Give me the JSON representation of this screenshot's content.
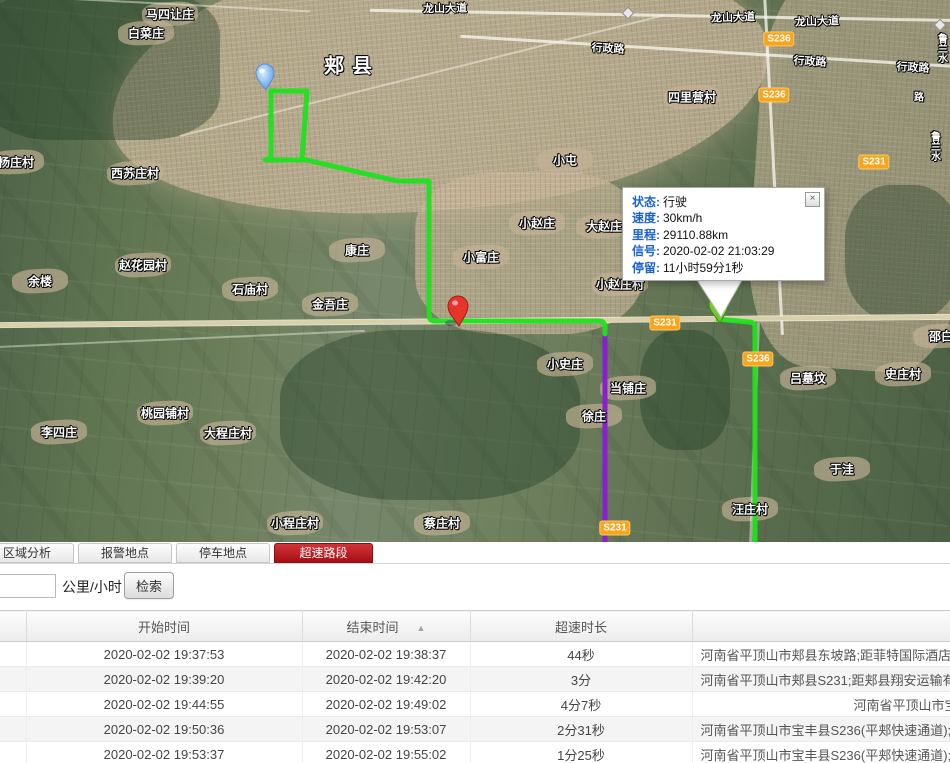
{
  "map": {
    "popup": {
      "rows": [
        {
          "label": "状态:",
          "value": "行驶"
        },
        {
          "label": "速度:",
          "value": "30km/h"
        },
        {
          "label": "里程:",
          "value": "29110.88km"
        },
        {
          "label": "信号:",
          "value": "2020-02-02 21:03:29"
        },
        {
          "label": "停留:",
          "value": "11小时59分1秒"
        }
      ],
      "close": "×"
    },
    "route_colors": {
      "track": "#1fe11f",
      "overspeed": "#8a1fd2"
    },
    "markers": [
      "start-balloon-marker",
      "red-pin-marker",
      "vehicle-green-marker"
    ],
    "labels": [
      {
        "text": "马四让庄",
        "x": 170,
        "y": 14,
        "blob": true
      },
      {
        "text": "白菜庄",
        "x": 146,
        "y": 33,
        "blob": true
      },
      {
        "text": "龙山大道",
        "x": 445,
        "y": 8,
        "size": 11,
        "rot": -1
      },
      {
        "text": "龙山大道",
        "x": 733,
        "y": 17,
        "size": 11,
        "rot": -2
      },
      {
        "text": "龙山大道",
        "x": 817,
        "y": 21,
        "size": 11,
        "rot": -2
      },
      {
        "text": "行政路",
        "x": 608,
        "y": 48,
        "size": 11,
        "rot": 3
      },
      {
        "text": "行政路",
        "x": 810,
        "y": 61,
        "size": 11,
        "rot": 3
      },
      {
        "text": "行政路",
        "x": 913,
        "y": 67,
        "size": 11,
        "rot": 3
      },
      {
        "text": "郏县",
        "x": 352,
        "y": 64,
        "size": 20,
        "ls": 8
      },
      {
        "text": "四里营村",
        "x": 692,
        "y": 97,
        "blob": true
      },
      {
        "text": "小屯",
        "x": 565,
        "y": 160,
        "blob": true
      },
      {
        "text": "杨庄村",
        "x": 16,
        "y": 162,
        "blob": true
      },
      {
        "text": "西苏庄村",
        "x": 135,
        "y": 173,
        "blob": true
      },
      {
        "text": "小赵庄",
        "x": 537,
        "y": 223,
        "blob": true
      },
      {
        "text": "大赵庄",
        "x": 604,
        "y": 226,
        "blob": true
      },
      {
        "text": "康庄",
        "x": 357,
        "y": 250,
        "blob": true
      },
      {
        "text": "小富庄",
        "x": 481,
        "y": 257,
        "blob": true
      },
      {
        "text": "赵花园村",
        "x": 143,
        "y": 265,
        "blob": true
      },
      {
        "text": "余楼",
        "x": 40,
        "y": 281,
        "blob": true
      },
      {
        "text": "石庙村",
        "x": 250,
        "y": 289,
        "blob": true
      },
      {
        "text": "金吾庄",
        "x": 330,
        "y": 304,
        "blob": true
      },
      {
        "text": "小赵庄村",
        "x": 620,
        "y": 284,
        "blob": true
      },
      {
        "text": "邵白",
        "x": 941,
        "y": 336,
        "blob": true
      },
      {
        "text": "小史庄",
        "x": 565,
        "y": 364,
        "blob": true
      },
      {
        "text": "当铺庄",
        "x": 628,
        "y": 388,
        "blob": true
      },
      {
        "text": "吕墓坟",
        "x": 808,
        "y": 378,
        "blob": true
      },
      {
        "text": "史庄村",
        "x": 903,
        "y": 374,
        "blob": true
      },
      {
        "text": "徐庄",
        "x": 594,
        "y": 416,
        "blob": true
      },
      {
        "text": "于洼",
        "x": 842,
        "y": 469,
        "blob": true
      },
      {
        "text": "汪庄村",
        "x": 750,
        "y": 509,
        "blob": true
      },
      {
        "text": "李四庄",
        "x": 59,
        "y": 432,
        "blob": true
      },
      {
        "text": "桃园铺村",
        "x": 165,
        "y": 413,
        "blob": true
      },
      {
        "text": "大程庄村",
        "x": 228,
        "y": 433,
        "blob": true
      },
      {
        "text": "小程庄村",
        "x": 295,
        "y": 523,
        "blob": true
      },
      {
        "text": "蔡庄村",
        "x": 442,
        "y": 523,
        "blob": true
      },
      {
        "text": "鲁兰水",
        "x": 941,
        "y": 48,
        "size": 10,
        "vert": true
      },
      {
        "text": "路",
        "x": 919,
        "y": 96,
        "size": 10
      },
      {
        "text": "鲁兰水",
        "x": 934,
        "y": 146,
        "size": 10,
        "vert": true
      }
    ],
    "road_badges": [
      {
        "text": "S236",
        "x": 779,
        "y": 39
      },
      {
        "text": "S236",
        "x": 774,
        "y": 95
      },
      {
        "text": "S231",
        "x": 874,
        "y": 162
      },
      {
        "text": "S231",
        "x": 665,
        "y": 323
      },
      {
        "text": "S236",
        "x": 758,
        "y": 359
      },
      {
        "text": "S231",
        "x": 615,
        "y": 528
      }
    ],
    "icons": [
      {
        "x": 628,
        "y": 13
      },
      {
        "x": 940,
        "y": 25
      }
    ]
  },
  "tabs": [
    {
      "label": "区域分析",
      "active": false
    },
    {
      "label": "报警地点",
      "active": false
    },
    {
      "label": "停车地点",
      "active": false
    },
    {
      "label": "超速路段",
      "active": true
    }
  ],
  "search": {
    "value": "",
    "unit": "公里/小时",
    "button": "检索"
  },
  "table": {
    "headers": {
      "col0": "",
      "start": "开始时间",
      "end": "结束时间",
      "duration": "超速时长",
      "location": ""
    },
    "sort_icon": "▲",
    "rows": [
      {
        "start": "2020-02-02 19:37:53",
        "end": "2020-02-02 19:38:37",
        "duration": "44秒",
        "location": "河南省平顶山市郏县东坡路;距菲特国际酒店",
        "short": false
      },
      {
        "start": "2020-02-02 19:39:20",
        "end": "2020-02-02 19:42:20",
        "duration": "3分",
        "location": "河南省平顶山市郏县S231;距郏县翔安运输有",
        "short": false
      },
      {
        "start": "2020-02-02 19:44:55",
        "end": "2020-02-02 19:49:02",
        "duration": "4分7秒",
        "location": "河南省平顶山市宝",
        "short": true
      },
      {
        "start": "2020-02-02 19:50:36",
        "end": "2020-02-02 19:53:07",
        "duration": "2分31秒",
        "location": "河南省平顶山市宝丰县S236(平郏快速通道);",
        "short": false
      },
      {
        "start": "2020-02-02 19:53:37",
        "end": "2020-02-02 19:55:02",
        "duration": "1分25秒",
        "location": "河南省平顶山市宝丰县S236(平郏快速通道);",
        "short": false
      }
    ]
  }
}
